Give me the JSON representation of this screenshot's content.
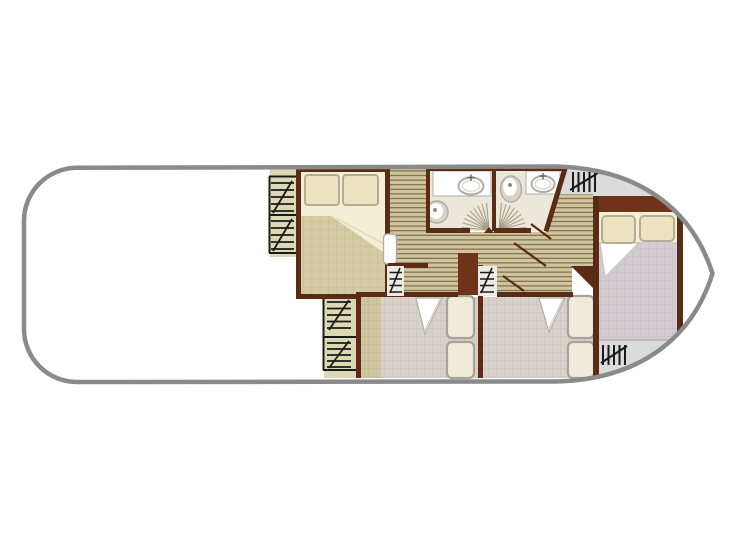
{
  "figure": {
    "kind": "boat-floorplan",
    "rooms": [
      "main-deck",
      "double-cabin-front",
      "bathroom-left",
      "bathroom-right",
      "twin-cabin-1",
      "twin-cabin-2",
      "double-cabin-bow",
      "corridor"
    ],
    "icons": [
      "window-hatch-icon",
      "sliding-door-hatch-icon",
      "deck-stairs-hatch-icon",
      "companionway-steps-icon",
      "toilet-icon",
      "sink-icon",
      "shower-spray-icon",
      "door-swing-icon",
      "bed-icon",
      "pillow-icon",
      "wardrobe-icon"
    ]
  },
  "colors": {
    "hull_stroke": "#8a8a8a",
    "deck_white": "#ffffff",
    "wall": "#5a2b15",
    "wall_red": "#6e3319",
    "window_strip": "#dcd8b5",
    "plank_bg": "#cfc49c",
    "plank_line": "#77664a",
    "floor_beige": "#d2cba4",
    "floor_beige_line": "#c3bb93",
    "floor_tan": "#cdc6a0",
    "floor_tan_line": "#beb68c",
    "floor_pink": "#d7d0cb",
    "floor_pink_line": "#c9c0bb",
    "floor_gray": "#d3cdd1",
    "floor_gray_line": "#c4bdc2",
    "bathroom_floor": "#ece7db",
    "fixture_white": "#ffffff",
    "fixture_rim": "#b2ada3",
    "fixture_dot": "#8d8d85",
    "bed_fill": "#f0ebdb",
    "bed_stroke": "#a9a298",
    "pillow_fill": "#ebe3bf",
    "pillow_stroke": "#b4ad93",
    "cream": "#f3efd6",
    "cream_line": "#dcd6b8",
    "gray_deck": "#dbdbdb",
    "gray_deck_line": "#b7b0b4",
    "hatch_black": "#1a1a1a",
    "fan_line": "#a79d85",
    "slide_bg": "#eceae6",
    "door_white": "#ffffff",
    "door_stroke": "#b3aea6",
    "tap": "#666666"
  }
}
